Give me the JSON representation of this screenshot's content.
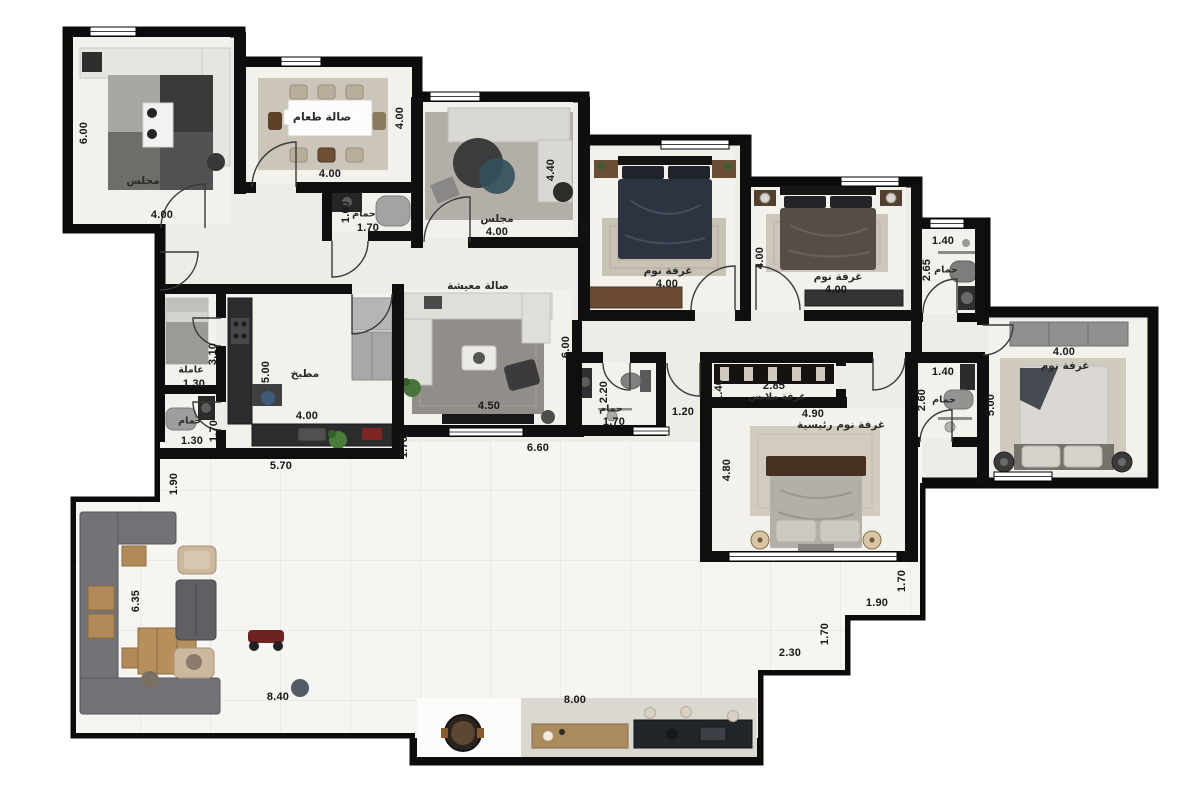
{
  "rooms": {
    "majlis_top": "مجلس",
    "dining": "صالة طعام",
    "bath_guest": "حمام",
    "majlis_small": "مجلس",
    "bedroom1": "غرفة نوم",
    "bedroom2": "غرفة نوم",
    "bath_top_right": "حمام",
    "living": "صالة معيشة",
    "kitchen": "مطبخ",
    "maid": "عاملة",
    "maid_bath": "حمام",
    "hall_bath": "حمام",
    "dressing": "غرفة ملابس",
    "master": "غرفة نوم رئيسية",
    "bath_right": "حمام",
    "bedroom3": "غرفة نوم"
  },
  "dims": {
    "majlis_top_h": "6.00",
    "majlis_top_w": "4.00",
    "dining_h": "4.00",
    "dining_w": "4.00",
    "bath_guest_h": "1.60",
    "bath_guest_w": "1.70",
    "majlis_small_h": "4.40",
    "majlis_small_w": "4.00",
    "bedroom1_h": "5.00",
    "bedroom1_w": "4.00",
    "bedroom2_h": "4.00",
    "bedroom2_w": "4.00",
    "bath_tr_w": "1.40",
    "bath_tr_h": "2.65",
    "living_w": "4.50",
    "living_h": "6.00",
    "hall_w": "6.60",
    "hall_side": "1.70",
    "kitchen_h": "5.00",
    "kitchen_w": "4.00",
    "kitchen_total": "5.70",
    "maid_h": "3.10",
    "maid_w": "1.30",
    "maid_bath_h": "1.70",
    "maid_bath_w": "1.30",
    "left_pass": "1.90",
    "hall_bath_h": "2.20",
    "hall_bath_w": "1.70",
    "corridor": "1.20",
    "dressing_h": "1.40",
    "dressing_w": "2.85",
    "master_w": "4.90",
    "master_h": "4.80",
    "bath_r_w": "1.40",
    "bath_r_h": "2.60",
    "bedroom3_w": "4.00",
    "bedroom3_h": "5.00",
    "family_h": "6.35",
    "family_w": "8.40",
    "terrace_w": "8.00",
    "step1_h": "1.70",
    "step1_w": "1.90",
    "step2_h": "1.70",
    "step2_w": "2.30"
  }
}
